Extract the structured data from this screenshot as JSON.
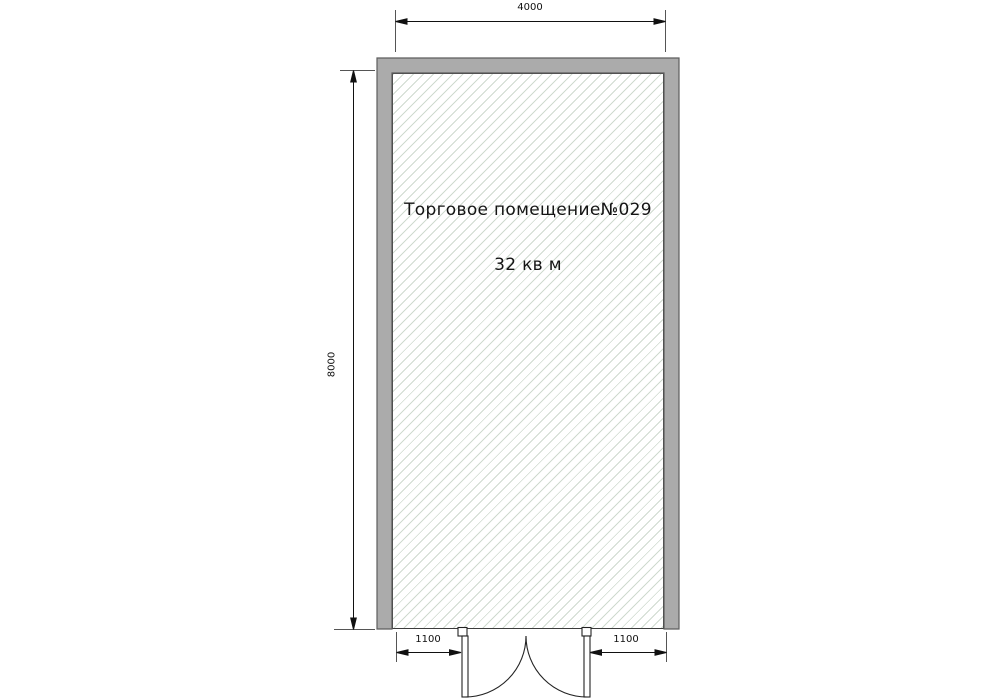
{
  "floor_plan": {
    "room": {
      "name": "Торговое помещение№029",
      "area": "32 кв м"
    },
    "dimensions": {
      "width_top": "4000",
      "height_left": "8000",
      "door_offset_left": "1100",
      "door_offset_right": "1100"
    },
    "colors": {
      "wall_fill": "#ababab",
      "wall_outline": "#5e5e5e",
      "hatch_line": "#cfdacf",
      "interior_outline": "#3c3c3c",
      "dimension_line": "#111111"
    }
  }
}
